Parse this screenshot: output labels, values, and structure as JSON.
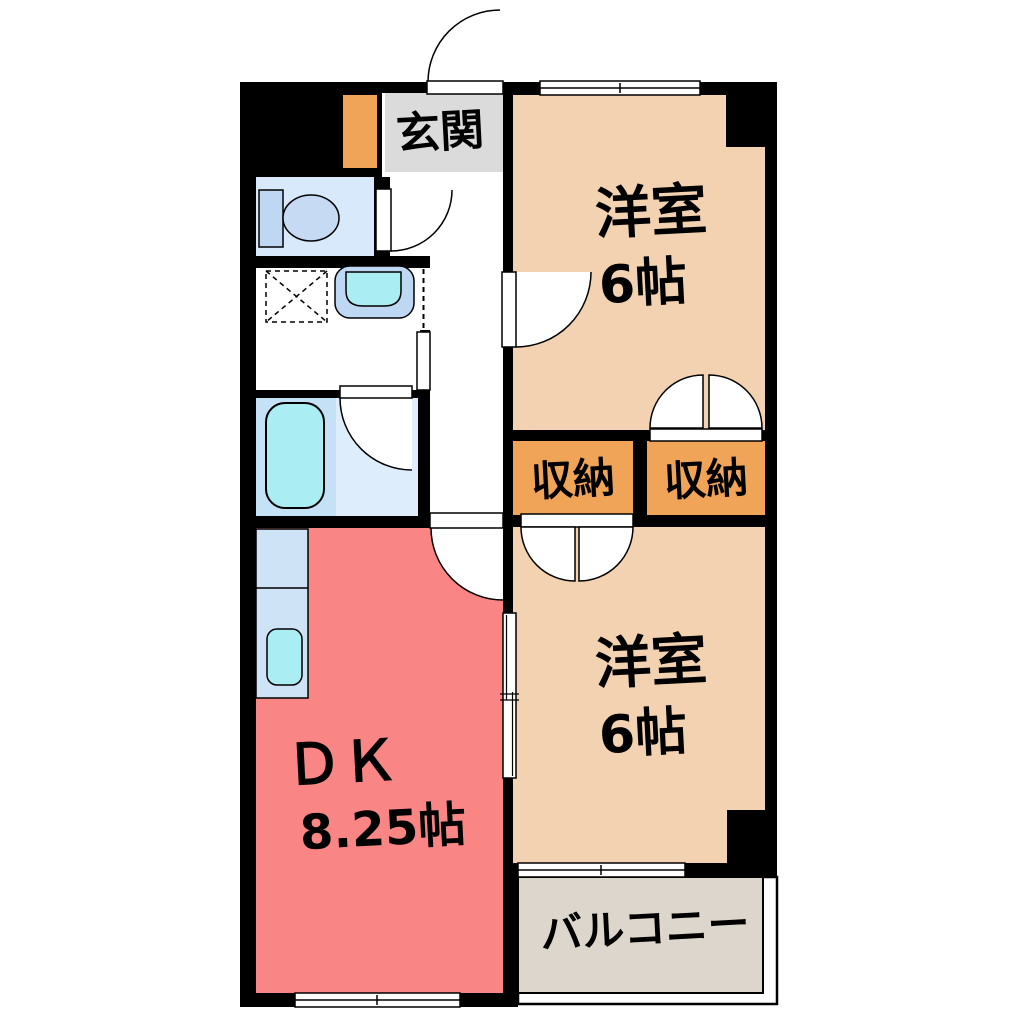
{
  "plan": {
    "background": "#ffffff",
    "wall_color": "#000000",
    "rooms": {
      "genkan": {
        "label": "玄関",
        "color": "#dbdbdb"
      },
      "western_top": {
        "label": "洋室",
        "size": "6帖",
        "color": "#f2d2b0"
      },
      "western_bottom": {
        "label": "洋室",
        "size": "6帖",
        "color": "#f2d2b0"
      },
      "closet_left": {
        "label": "収納",
        "color": "#f0a458"
      },
      "closet_right": {
        "label": "収納",
        "color": "#f0a458"
      },
      "dk": {
        "label": "ＤＫ",
        "size": "8.25帖",
        "color": "#f98585"
      },
      "balcony": {
        "label": "バルコニー",
        "color": "#dcd6cc"
      }
    },
    "fixtures": {
      "shoe_cabinet_color": "#f0a458",
      "toilet_floor": "#d8e9fb",
      "toilet_tank": "#bed8f3",
      "toilet_bowl": "#c6daf4",
      "bath_floor_left": "#c4e1f6",
      "bath_floor_right": "#deedfb",
      "bathtub": "#aaedf3",
      "sink_outer": "#bed8f3",
      "sink_basin": "#aaedf3",
      "kitchen_counter": "#cfe3f7",
      "kitchen_sink": "#aaedf3"
    }
  }
}
